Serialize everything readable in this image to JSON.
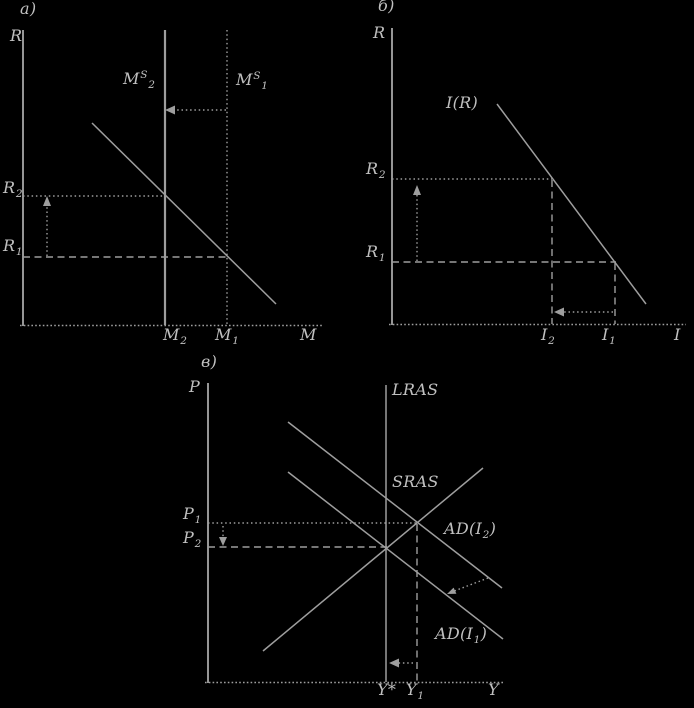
{
  "colors": {
    "background": "#000000",
    "line": "#9e9e9e",
    "text": "#c0c0c0"
  },
  "panel_a": {
    "title": "а)",
    "y_axis_label": "R",
    "x_axis_label": "M",
    "ms2": {
      "base": "M",
      "sup": "S",
      "sub": "2"
    },
    "ms1": {
      "base": "M",
      "sup": "S",
      "sub": "1"
    },
    "r2": {
      "base": "R",
      "sub": "2"
    },
    "r1": {
      "base": "R",
      "sub": "1"
    },
    "m2": {
      "base": "M",
      "sub": "2"
    },
    "m1": {
      "base": "M",
      "sub": "1"
    }
  },
  "panel_b": {
    "title": "б)",
    "y_axis_label": "R",
    "x_axis_label": "I",
    "investment_curve_label": "I(R)",
    "r2": {
      "base": "R",
      "sub": "2"
    },
    "r1": {
      "base": "R",
      "sub": "1"
    },
    "i2": {
      "base": "I",
      "sub": "2"
    },
    "i1": {
      "base": "I",
      "sub": "1"
    }
  },
  "panel_v": {
    "title": "в)",
    "y_axis_label": "P",
    "x_axis_label": "Y",
    "lras_label": "LRAS",
    "sras_label": "SRAS",
    "ad2": {
      "pre": "AD(I",
      "sub": "2",
      "post": ")"
    },
    "ad1": {
      "pre": "AD(I",
      "sub": "1",
      "post": ")"
    },
    "p1": {
      "base": "P",
      "sub": "1"
    },
    "p2": {
      "base": "P",
      "sub": "2"
    },
    "y_star": "Y*",
    "y1": {
      "base": "Y",
      "sub": "1"
    }
  }
}
